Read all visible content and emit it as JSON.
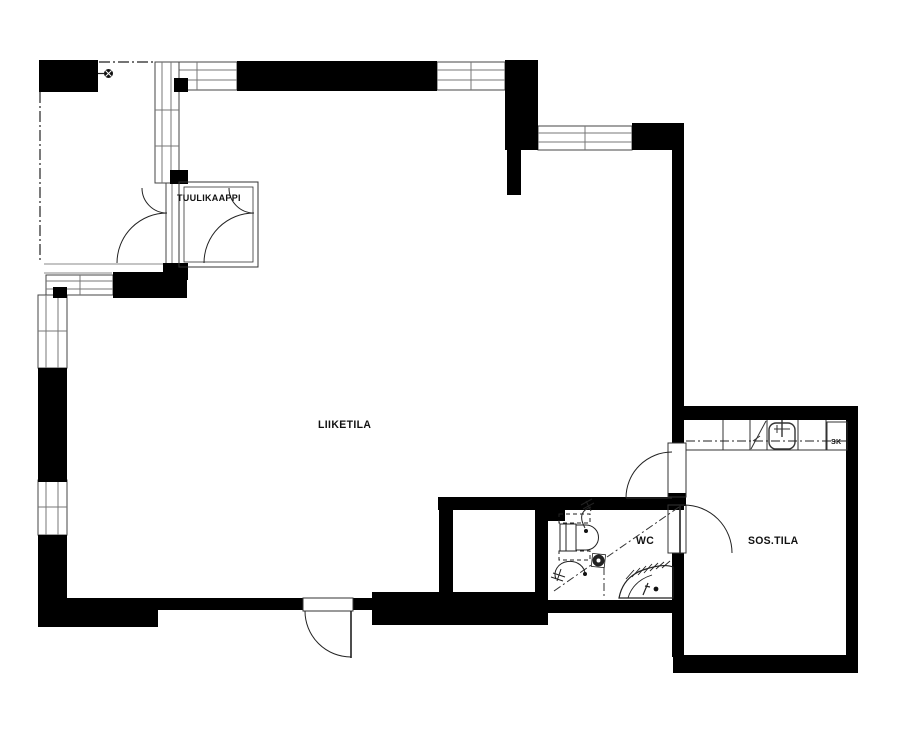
{
  "page": {
    "background_color": "#ffffff",
    "wall_color": "#000000",
    "line_color": "#2b2b2b"
  },
  "rooms": {
    "tuulikaappi": "TUULIKAAPPI",
    "liiketila": "LIIKETILA",
    "wc": "WC",
    "sos_tila": "SOS.TILA",
    "sk_closet": "SK"
  },
  "fixtures": {
    "wc_fixtures": [
      "toilet",
      "floor-drain",
      "corner-sink",
      "water-valve",
      "water-valve"
    ],
    "kitchenette_fixtures": [
      "cabinet-run",
      "dishwasher",
      "kitchen-sink",
      "sk-closet"
    ],
    "other_symbols": [
      "column",
      "roof-line",
      "entrance-doors"
    ]
  }
}
